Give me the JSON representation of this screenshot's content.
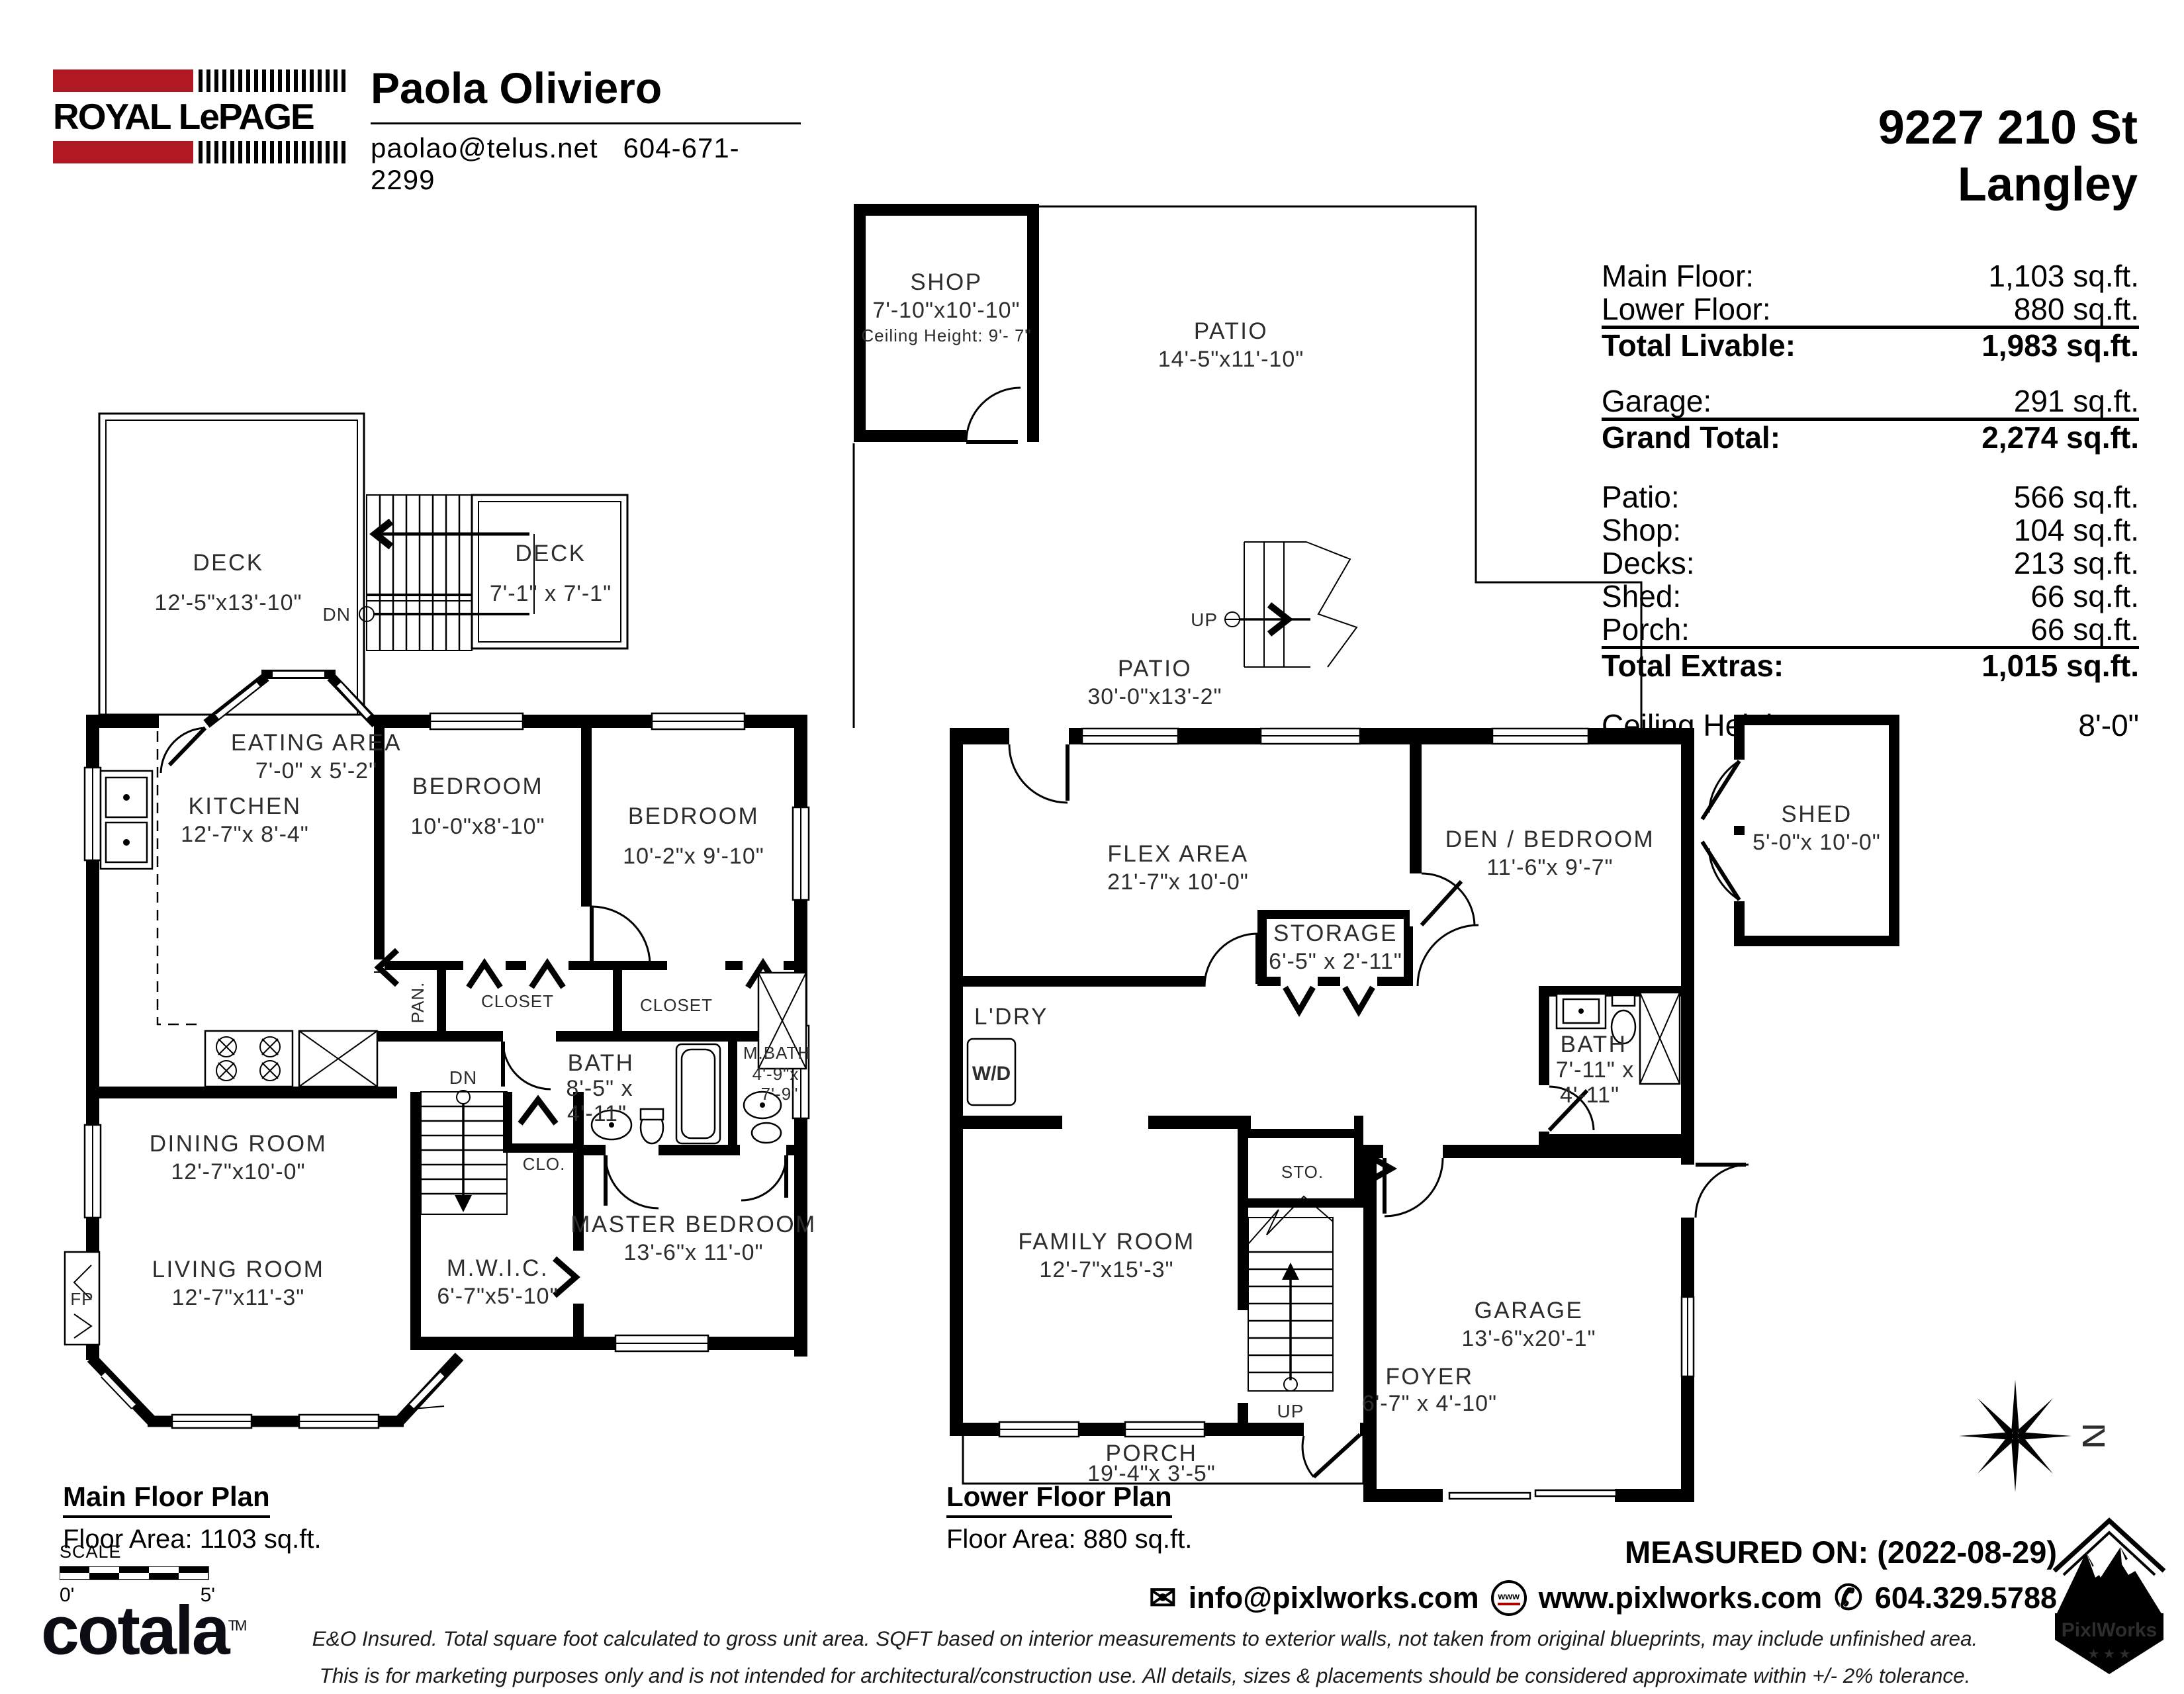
{
  "header": {
    "brand": {
      "name": "ROYAL LePAGE"
    },
    "agent": {
      "name": "Paola Oliviero",
      "email": "paolao@telus.net",
      "phone": "604-671-2299"
    },
    "address": {
      "line1": "9227 210 St",
      "line2": "Langley"
    }
  },
  "summary": {
    "rows": [
      {
        "label": "Main Floor:",
        "value": "1,103 sq.ft."
      },
      {
        "label": "Lower Floor:",
        "value": "880 sq.ft."
      },
      {
        "label": "Total Livable:",
        "value": "1,983 sq.ft."
      },
      {
        "label": "Garage:",
        "value": "291 sq.ft."
      },
      {
        "label": "Grand Total:",
        "value": "2,274 sq.ft."
      },
      {
        "label": "Patio:",
        "value": "566 sq.ft."
      },
      {
        "label": "Shop:",
        "value": "104 sq.ft."
      },
      {
        "label": "Decks:",
        "value": "213 sq.ft."
      },
      {
        "label": "Shed:",
        "value": "66 sq.ft."
      },
      {
        "label": "Porch:",
        "value": "66 sq.ft."
      },
      {
        "label": "Total Extras:",
        "value": "1,015 sq.ft."
      },
      {
        "label": "Ceiling Height:",
        "value": "8'-0\""
      }
    ]
  },
  "main_floor": {
    "title": "Main Floor Plan",
    "floor_area": "Floor Area: 1103 sq.ft.",
    "markers": {
      "dn": "DN"
    },
    "rooms": {
      "deck_large": {
        "name": "DECK",
        "dims": "12'-5\"x13'-10\""
      },
      "deck_small": {
        "name": "DECK",
        "dims": "7'-1\" x 7'-1\""
      },
      "eating": {
        "name": "EATING AREA",
        "dims": "7'-0\" x 5'-2\""
      },
      "kitchen": {
        "name": "KITCHEN",
        "dims": "12'-7\"x 8'-4\""
      },
      "bedroom1": {
        "name": "BEDROOM",
        "dims": "10'-0\"x8'-10\""
      },
      "bedroom2": {
        "name": "BEDROOM",
        "dims": "10'-2\"x 9'-10\""
      },
      "closet1": {
        "name": "CLOSET"
      },
      "closet2": {
        "name": "CLOSET"
      },
      "pantry": {
        "name": "PAN."
      },
      "bath": {
        "name": "BATH",
        "dims1": "8'-5\" x",
        "dims2": "4'-11\""
      },
      "mbath": {
        "name": "M.BATH",
        "dims1": "4'-9\"x",
        "dims2": "7'-9\""
      },
      "dining": {
        "name": "DINING ROOM",
        "dims": "12'-7\"x10'-0\""
      },
      "master": {
        "name": "MASTER BEDROOM",
        "dims": "13'-6\"x 11'-0\""
      },
      "mwic": {
        "name": "M.W.I.C.",
        "dims": "6'-7\"x5'-10\""
      },
      "living": {
        "name": "LIVING ROOM",
        "dims": "12'-7\"x11'-3\""
      },
      "clo": {
        "name": "CLO."
      },
      "fp": {
        "name": "FP"
      }
    }
  },
  "lower_floor": {
    "title": "Lower Floor Plan",
    "floor_area": "Floor Area: 880 sq.ft.",
    "markers": {
      "up": "UP"
    },
    "rooms": {
      "shop": {
        "name": "SHOP",
        "dims": "7'-10\"x10'-10\"",
        "note": "Ceiling Height: 9'- 7\""
      },
      "patio1": {
        "name": "PATIO",
        "dims": "14'-5\"x11'-10\""
      },
      "patio2": {
        "name": "PATIO",
        "dims": "30'-0\"x13'-2\""
      },
      "flex": {
        "name": "FLEX AREA",
        "dims": "21'-7\"x 10'-0\""
      },
      "den": {
        "name": "DEN / BEDROOM",
        "dims": "11'-6\"x 9'-7\""
      },
      "storage": {
        "name": "STORAGE",
        "dims": "6'-5\" x 2'-11\""
      },
      "laundry": {
        "name": "L'DRY"
      },
      "wd": {
        "name": "W/D"
      },
      "bath": {
        "name": "BATH",
        "dims1": "7'-11\"  x",
        "dims2": "4'-11\""
      },
      "sto": {
        "name": "STO."
      },
      "family": {
        "name": "FAMILY ROOM",
        "dims": "12'-7\"x15'-3\""
      },
      "garage": {
        "name": "GARAGE",
        "dims": "13'-6\"x20'-1\""
      },
      "foyer": {
        "name": "FOYER",
        "dims": "6'-7\" x 4'-10\""
      },
      "porch": {
        "name": "PORCH",
        "dims": "19'-4\"x  3'-5\""
      },
      "shed": {
        "name": "SHED",
        "dims": "5'-0\"x 10'-0\""
      }
    }
  },
  "scale_bar": {
    "label": "SCALE",
    "start": "0'",
    "end": "5'"
  },
  "footer": {
    "cotala": "cotala",
    "cotala_tm": "TM",
    "disclaimer1": "E&O Insured.  Total square foot calculated to gross unit area. SQFT based on interior measurements to exterior walls, not taken from original blueprints, may include unfinished area.",
    "disclaimer2": "This is for marketing purposes only and is not intended for architectural/construction use.  All details, sizes & placements should be considered approximate within +/- 2%  tolerance.",
    "measured_on": "MEASURED ON: (2022-08-29)",
    "contact": {
      "email": "info@pixlworks.com",
      "web": "www.pixlworks.com",
      "www_badge": "www",
      "phone": "604.329.5788"
    },
    "pixlworks": "PixlWorks",
    "stars": "★ ★ ★",
    "compass_n": "N"
  }
}
